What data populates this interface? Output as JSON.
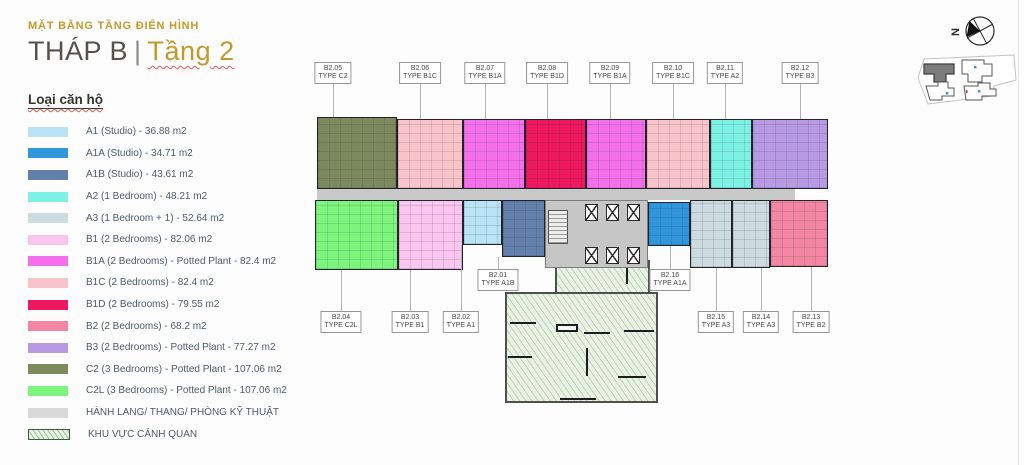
{
  "header": {
    "eyebrow": "MẶT BẰNG TẦNG ĐIỂN HÌNH",
    "tower": "THÁP B",
    "divider": "|",
    "floor": "Tầng 2"
  },
  "legend": {
    "heading": "Loại căn hộ",
    "items": [
      {
        "code": "A1",
        "label": "A1 (Studio) - 36.88 m2",
        "color": "#b8e4f5"
      },
      {
        "code": "A1A",
        "label": "A1A (Studio) - 34.71 m2",
        "color": "#2f96db"
      },
      {
        "code": "A1B",
        "label": "A1B (Studio) - 43.61 m2",
        "color": "#6380ab"
      },
      {
        "code": "A2",
        "label": "A2 (1 Bedroom) - 48.21 m2",
        "color": "#7df2e4"
      },
      {
        "code": "A3",
        "label": "A3 (1 Bedroom + 1) - 52.64 m2",
        "color": "#ccdbe0"
      },
      {
        "code": "B1",
        "label": "B1 (2 Bedrooms) - 82.06 m2",
        "color": "#fac5ef"
      },
      {
        "code": "B1A",
        "label": "B1A (2 Bedrooms) - Potted Plant - 82.4 m2",
        "color": "#f370ea"
      },
      {
        "code": "B1C",
        "label": "B1C (2 Bedrooms) - 82.4 m2",
        "color": "#f8c4ca"
      },
      {
        "code": "B1D",
        "label": "B1D (2 Bedrooms) - 79.55 m2",
        "color": "#ed185e"
      },
      {
        "code": "B2",
        "label": "B2 (2 Bedrooms) - 68.2 m2",
        "color": "#f387a3"
      },
      {
        "code": "B3",
        "label": "B3 (2 Bedrooms) - Potted Plant - 77.27 m2",
        "color": "#b79ae3"
      },
      {
        "code": "C2",
        "label": "C2 (3 Bedrooms) - Potted Plant - 107.06 m2",
        "color": "#7d8a5e"
      },
      {
        "code": "C2L",
        "label": "C2L (3 Bedrooms) - Potted Plant - 107.06 m2",
        "color": "#7df57d"
      },
      {
        "code": "corridor",
        "label": "HÀNH LANG/ THANG/ PHÒNG KỸ THUẬT",
        "color": "#d9d9d9"
      },
      {
        "code": "landscape",
        "label": "KHU VỰC CẢNH QUAN",
        "color": "#e9f3e5",
        "hatch": true
      }
    ]
  },
  "plan": {
    "units": [
      {
        "id": "B2.05",
        "type": "C2",
        "x": 317,
        "y": 117,
        "w": 80,
        "h": 72
      },
      {
        "id": "B2.06",
        "type": "B1C",
        "x": 397,
        "y": 119,
        "w": 66,
        "h": 70
      },
      {
        "id": "B2.07",
        "type": "B1A",
        "x": 463,
        "y": 119,
        "w": 62,
        "h": 70
      },
      {
        "id": "B2.08",
        "type": "B1D",
        "x": 525,
        "y": 119,
        "w": 61,
        "h": 70
      },
      {
        "id": "B2.09",
        "type": "B1A",
        "x": 586,
        "y": 119,
        "w": 60,
        "h": 70
      },
      {
        "id": "B2.10",
        "type": "B1C",
        "x": 646,
        "y": 119,
        "w": 64,
        "h": 70
      },
      {
        "id": "B2.11",
        "type": "A2",
        "x": 710,
        "y": 119,
        "w": 42,
        "h": 70
      },
      {
        "id": "B2.12",
        "type": "B3",
        "x": 752,
        "y": 119,
        "w": 76,
        "h": 70
      },
      {
        "id": "B2.04",
        "type": "C2L",
        "x": 315,
        "y": 200,
        "w": 83,
        "h": 70
      },
      {
        "id": "B2.03",
        "type": "B1",
        "x": 398,
        "y": 200,
        "w": 65,
        "h": 70
      },
      {
        "id": "B2.02",
        "type": "A1",
        "x": 463,
        "y": 200,
        "w": 39,
        "h": 45
      },
      {
        "id": "B2.01",
        "type": "A1B",
        "x": 502,
        "y": 200,
        "w": 43,
        "h": 57
      },
      {
        "id": "B2.16",
        "type": "A1A",
        "x": 648,
        "y": 202,
        "w": 42,
        "h": 44
      },
      {
        "id": "B2.15",
        "type": "A3",
        "x": 690,
        "y": 200,
        "w": 42,
        "h": 68
      },
      {
        "id": "B2.14",
        "type": "A3",
        "x": 732,
        "y": 200,
        "w": 38,
        "h": 68
      },
      {
        "id": "B2.13",
        "type": "B2",
        "x": 770,
        "y": 200,
        "w": 58,
        "h": 67
      }
    ],
    "labels": [
      {
        "unit": "B2.05",
        "type": "TYPE C2",
        "x": 333,
        "top": 62,
        "ly1": 81,
        "ly2": 117
      },
      {
        "unit": "B2.06",
        "type": "TYPE B1C",
        "x": 420,
        "top": 62,
        "ly1": 81,
        "ly2": 119
      },
      {
        "unit": "B2.07",
        "type": "TYPE B1A",
        "x": 485,
        "top": 62,
        "ly1": 81,
        "ly2": 119
      },
      {
        "unit": "B2.08",
        "type": "TYPE B1D",
        "x": 547,
        "top": 62,
        "ly1": 81,
        "ly2": 119
      },
      {
        "unit": "B2.09",
        "type": "TYPE B1A",
        "x": 610,
        "top": 62,
        "ly1": 81,
        "ly2": 119
      },
      {
        "unit": "B2.10",
        "type": "TYPE B1C",
        "x": 673,
        "top": 62,
        "ly1": 81,
        "ly2": 119
      },
      {
        "unit": "B2.11",
        "type": "TYPE A2",
        "x": 725,
        "top": 62,
        "ly1": 81,
        "ly2": 119
      },
      {
        "unit": "B2.12",
        "type": "TYPE B3",
        "x": 800,
        "top": 62,
        "ly1": 81,
        "ly2": 119
      },
      {
        "unit": "B2.01",
        "type": "TYPE A1B",
        "x": 498,
        "top": 269,
        "ly1": 257,
        "ly2": 269
      },
      {
        "unit": "B2.16",
        "type": "TYPE A1A",
        "x": 670,
        "top": 269,
        "ly1": 246,
        "ly2": 269
      },
      {
        "unit": "B2.04",
        "type": "TYPE C2L",
        "x": 341,
        "top": 311,
        "ly1": 270,
        "ly2": 311
      },
      {
        "unit": "B2.03",
        "type": "TYPE B1",
        "x": 410,
        "top": 311,
        "ly1": 270,
        "ly2": 311
      },
      {
        "unit": "B2.02",
        "type": "TYPE A1",
        "x": 461,
        "top": 311,
        "ly1": 245,
        "ly2": 311
      },
      {
        "unit": "B2.15",
        "type": "TYPE A3",
        "x": 716,
        "top": 311,
        "ly1": 268,
        "ly2": 311
      },
      {
        "unit": "B2.14",
        "type": "TYPE A3",
        "x": 761,
        "top": 311,
        "ly1": 268,
        "ly2": 311
      },
      {
        "unit": "B2.13",
        "type": "TYPE B2",
        "x": 811,
        "top": 311,
        "ly1": 267,
        "ly2": 311
      }
    ],
    "corridor": {
      "x": 317,
      "y": 189,
      "w": 478,
      "h": 11
    },
    "core": {
      "x": 545,
      "y": 200,
      "w": 103,
      "h": 68
    },
    "lifts": [
      [
        585,
        204
      ],
      [
        606,
        204
      ],
      [
        627,
        204
      ],
      [
        585,
        247
      ],
      [
        606,
        247
      ],
      [
        627,
        247
      ]
    ],
    "stairs": [
      {
        "x": 548,
        "y": 210,
        "w": 20,
        "h": 34
      },
      {
        "x": 752,
        "y": 152,
        "w": 22,
        "h": 36
      }
    ],
    "landscape": {
      "areas": [
        {
          "x": 555,
          "y": 260,
          "w": 95,
          "h": 34
        },
        {
          "x": 505,
          "y": 292,
          "w": 153,
          "h": 111
        }
      ],
      "walls": [
        [
          510,
          322,
          26,
          2
        ],
        [
          584,
          332,
          26,
          2
        ],
        [
          624,
          330,
          30,
          2
        ],
        [
          508,
          356,
          24,
          2
        ],
        [
          586,
          348,
          2,
          28
        ],
        [
          618,
          376,
          28,
          2
        ],
        [
          626,
          268,
          2,
          16
        ],
        [
          560,
          398,
          36,
          2
        ]
      ],
      "planter": [
        556,
        324,
        22,
        8
      ]
    }
  },
  "compass": {
    "north_label": "N"
  },
  "colors": {
    "accent_gold": "#c3992b",
    "title_dark": "#55534b",
    "wall": "#23232a",
    "corridor_fill": "#c9c9c9",
    "leader": "#b4b4b4",
    "highlight_building": "#7c7c7c"
  }
}
